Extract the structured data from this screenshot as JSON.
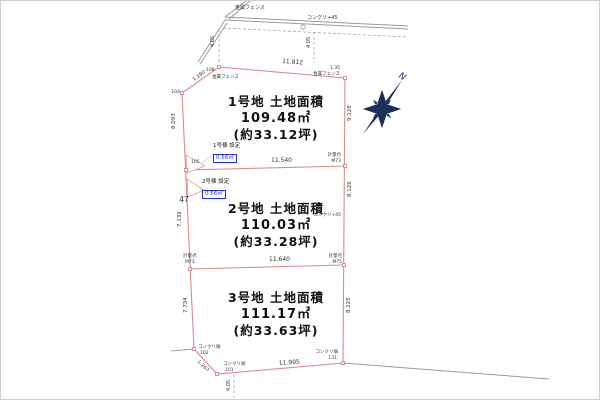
{
  "drawing": {
    "colors": {
      "boundary": "#d98c8c",
      "road": "#9a9a9a",
      "text": "#333333",
      "blue": "#2233cc",
      "compass": "#1c2f5a"
    },
    "plots": [
      {
        "title": "1号地 土地面積",
        "area": "109.48㎡",
        "tsubo": "(約33.12坪)"
      },
      {
        "title": "2号地 土地面積",
        "area": "110.03㎡",
        "tsubo": "(約33.28坪)"
      },
      {
        "title": "3号地 土地面積",
        "area": "111.17㎡",
        "tsubo": "(約33.63坪)"
      }
    ],
    "setbacks": [
      {
        "label": "1号棟 設定",
        "value": "0.56㎡"
      },
      {
        "label": "2号棟 設定",
        "value": "0.56㎡"
      }
    ],
    "compass_north": "N",
    "annotations": [
      {
        "n": "fence-label-top",
        "t": "金属フェンス",
        "x": 234,
        "y": 8,
        "s": 5
      },
      {
        "n": "road-mark-label",
        "t": "コンクリ+45",
        "x": 306,
        "y": 18,
        "s": 5
      },
      {
        "n": "dim-label",
        "t": "4.05",
        "x": 213,
        "y": 46,
        "s": 5,
        "r": -90
      },
      {
        "n": "dim-label",
        "t": "4.05",
        "x": 309,
        "y": 47,
        "s": 5,
        "r": -90
      },
      {
        "n": "dim-label",
        "t": "11.812",
        "x": 281,
        "y": 62,
        "s": 6,
        "r": 4
      },
      {
        "n": "point-label",
        "t": "108",
        "x": 205,
        "y": 70,
        "s": 4.5
      },
      {
        "n": "fence-label",
        "t": "金属フェンス",
        "x": 211,
        "y": 77,
        "s": 4.5
      },
      {
        "n": "dim-label",
        "t": "1.190",
        "x": 193,
        "y": 80,
        "s": 5,
        "r": -36
      },
      {
        "n": "point-label",
        "t": "104",
        "x": 179,
        "y": 92,
        "s": 4.5,
        "a": "end"
      },
      {
        "n": "dim-label",
        "t": "8.093",
        "x": 174,
        "y": 128,
        "s": 5.5,
        "r": -90
      },
      {
        "n": "dim-label",
        "t": "9.128",
        "x": 350,
        "y": 120,
        "s": 5.5,
        "r": -90
      },
      {
        "n": "dim-label",
        "t": "1.35",
        "x": 339,
        "y": 68,
        "s": 4.5,
        "a": "end"
      },
      {
        "n": "fence-label",
        "t": "金属フェンス",
        "x": 339,
        "y": 74,
        "s": 4.5,
        "a": "end"
      },
      {
        "n": "point-label",
        "t": "計量点",
        "x": 340,
        "y": 155,
        "s": 4.5,
        "a": "end"
      },
      {
        "n": "point-label",
        "t": "M73",
        "x": 340,
        "y": 161,
        "s": 4.5,
        "a": "end"
      },
      {
        "n": "dim-label",
        "t": "11.540",
        "x": 270,
        "y": 161,
        "s": 6
      },
      {
        "n": "point-label",
        "t": "105",
        "x": 190,
        "y": 162,
        "s": 4.5
      },
      {
        "n": "block-number",
        "t": "47",
        "x": 183,
        "y": 201,
        "s": 7.5,
        "a": "middle"
      },
      {
        "n": "dim-label",
        "t": "7.132",
        "x": 180,
        "y": 226,
        "s": 5.5,
        "r": -90
      },
      {
        "n": "wall-label",
        "t": "コンクリ+45",
        "x": 340,
        "y": 215,
        "s": 4.5,
        "a": "end"
      },
      {
        "n": "dim-label",
        "t": "8.126",
        "x": 350,
        "y": 196,
        "s": 5.5,
        "r": -90
      },
      {
        "n": "point-label",
        "t": "計量点",
        "x": 182,
        "y": 256,
        "s": 4.5
      },
      {
        "n": "point-label",
        "t": "M73",
        "x": 184,
        "y": 262,
        "s": 4.5
      },
      {
        "n": "point-label",
        "t": "計量点",
        "x": 341,
        "y": 256,
        "s": 4.5,
        "a": "end"
      },
      {
        "n": "point-label",
        "t": "M75",
        "x": 341,
        "y": 262,
        "s": 4.5,
        "a": "end"
      },
      {
        "n": "dim-label",
        "t": "11.640",
        "x": 268,
        "y": 260,
        "s": 6
      },
      {
        "n": "dim-label",
        "t": "7.734",
        "x": 186,
        "y": 312,
        "s": 5.5,
        "r": -90
      },
      {
        "n": "dim-label",
        "t": "8.125",
        "x": 349,
        "y": 312,
        "s": 5.5,
        "r": -90
      },
      {
        "n": "wall-label",
        "t": "コンクリ塀",
        "x": 197,
        "y": 347,
        "s": 4.5
      },
      {
        "n": "point-label",
        "t": "102",
        "x": 199,
        "y": 353,
        "s": 4.5
      },
      {
        "n": "dim-label",
        "t": "1.267",
        "x": 196,
        "y": 361,
        "s": 5,
        "r": 44
      },
      {
        "n": "wall-label",
        "t": "コンクリ塀",
        "x": 222,
        "y": 364,
        "s": 4.5
      },
      {
        "n": "point-label",
        "t": "101",
        "x": 224,
        "y": 370,
        "s": 4.5
      },
      {
        "n": "dim-label",
        "t": "11.995",
        "x": 278,
        "y": 364,
        "s": 6,
        "r": -4
      },
      {
        "n": "wall-label",
        "t": "コンクリ塀",
        "x": 337,
        "y": 352,
        "s": 4.5,
        "a": "end"
      },
      {
        "n": "point-label",
        "t": "131",
        "x": 336,
        "y": 358,
        "s": 4.5,
        "a": "end"
      },
      {
        "n": "dim-label",
        "t": "4.05",
        "x": 229,
        "y": 390,
        "s": 5,
        "r": -90
      }
    ]
  }
}
